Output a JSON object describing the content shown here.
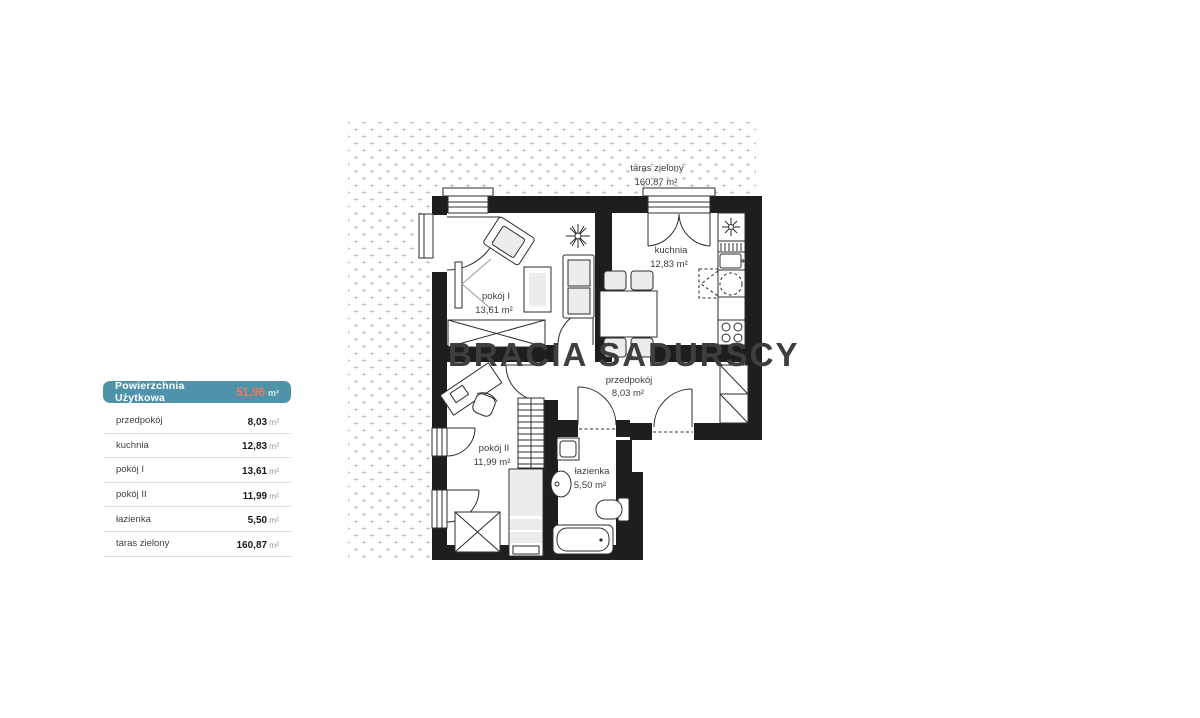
{
  "legend": {
    "header": {
      "label": "Powierzchnia Użytkowa",
      "value": "51,96",
      "unit": "m²"
    },
    "rows": [
      {
        "label": "przedpokój",
        "value": "8,03",
        "unit": "m²"
      },
      {
        "label": "kuchnia",
        "value": "12,83",
        "unit": "m²"
      },
      {
        "label": "pokój I",
        "value": "13,61",
        "unit": "m²"
      },
      {
        "label": "pokój II",
        "value": "11,99",
        "unit": "m²"
      },
      {
        "label": "łazienka",
        "value": "5,50",
        "unit": "m²"
      },
      {
        "label": "taras zielony",
        "value": "160,87",
        "unit": "m²"
      }
    ]
  },
  "plan": {
    "terrace": {
      "name": "taras zielony",
      "area": "160,87 m²"
    },
    "rooms": [
      {
        "name": "pokój I",
        "area": "13,61 m²"
      },
      {
        "name": "kuchnia",
        "area": "12,83 m²"
      },
      {
        "name": "przedpokój",
        "area": "8,03 m²"
      },
      {
        "name": "pokój II",
        "area": "11,99 m²"
      },
      {
        "name": "łazienka",
        "area": "5,50 m²"
      }
    ],
    "watermark": "BRACIA SADURSCY"
  },
  "colors": {
    "header_bg": "#4f93aa",
    "accent_orange": "#e87a5a",
    "wall": "#1e1e1e",
    "terrace_dots": "#c2c2c2"
  }
}
